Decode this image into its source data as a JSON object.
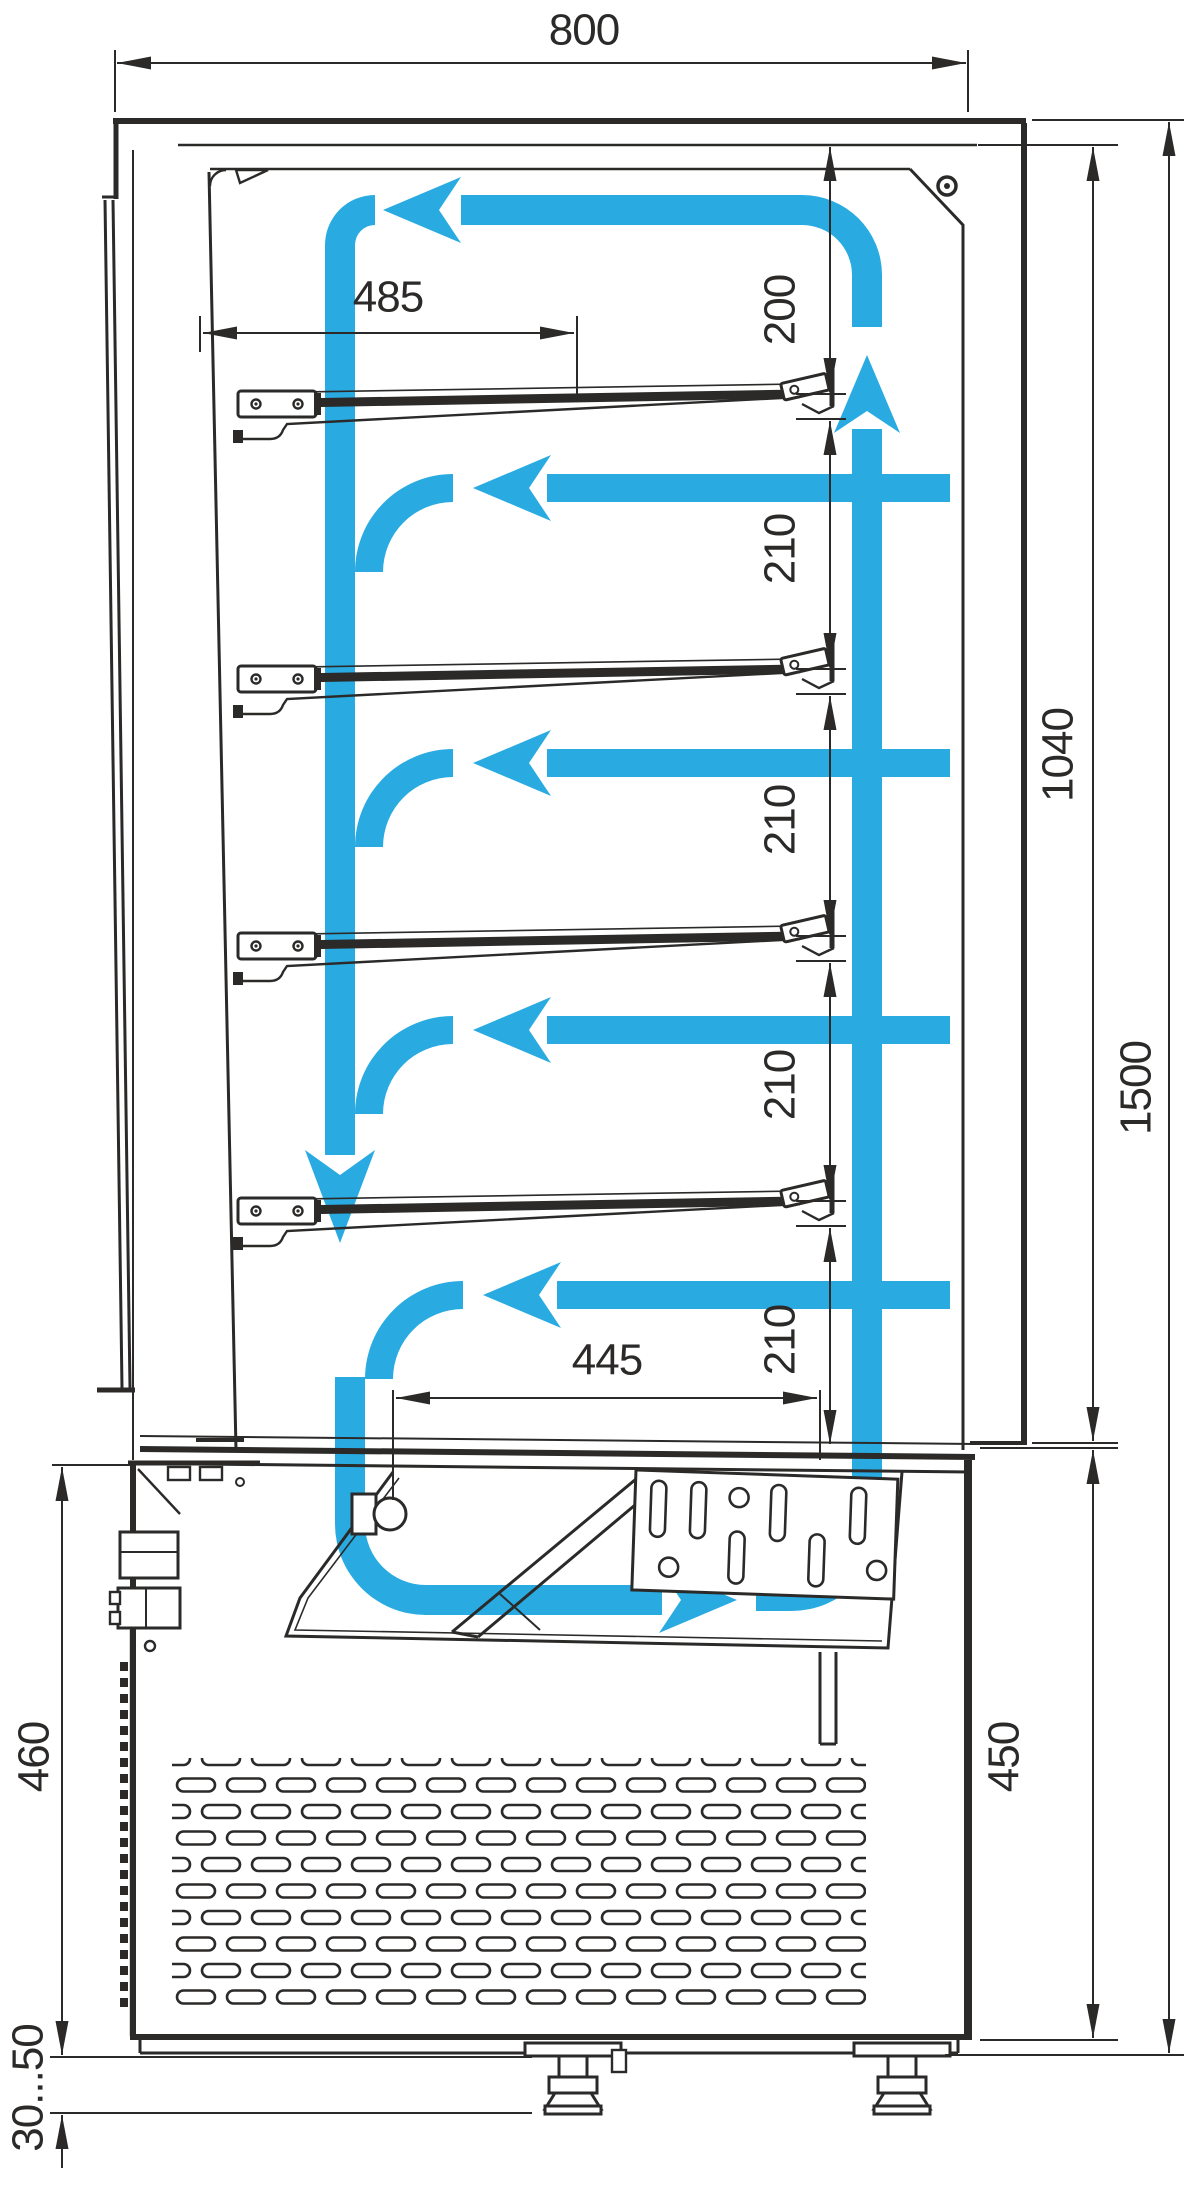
{
  "dimensions": {
    "overall_width": "800",
    "shelf_depth": "485",
    "top_gap": "200",
    "shelf_gaps": [
      "210",
      "210",
      "210",
      "210"
    ],
    "display_height": "1040",
    "overall_height": "1500",
    "well_opening": "445",
    "base_height_back": "460",
    "base_height_front": "450",
    "foot_adjustment": "30...50"
  },
  "colors": {
    "airflow": "#29ABE2",
    "linework": "#2B2A29",
    "background": "#FFFFFF"
  }
}
